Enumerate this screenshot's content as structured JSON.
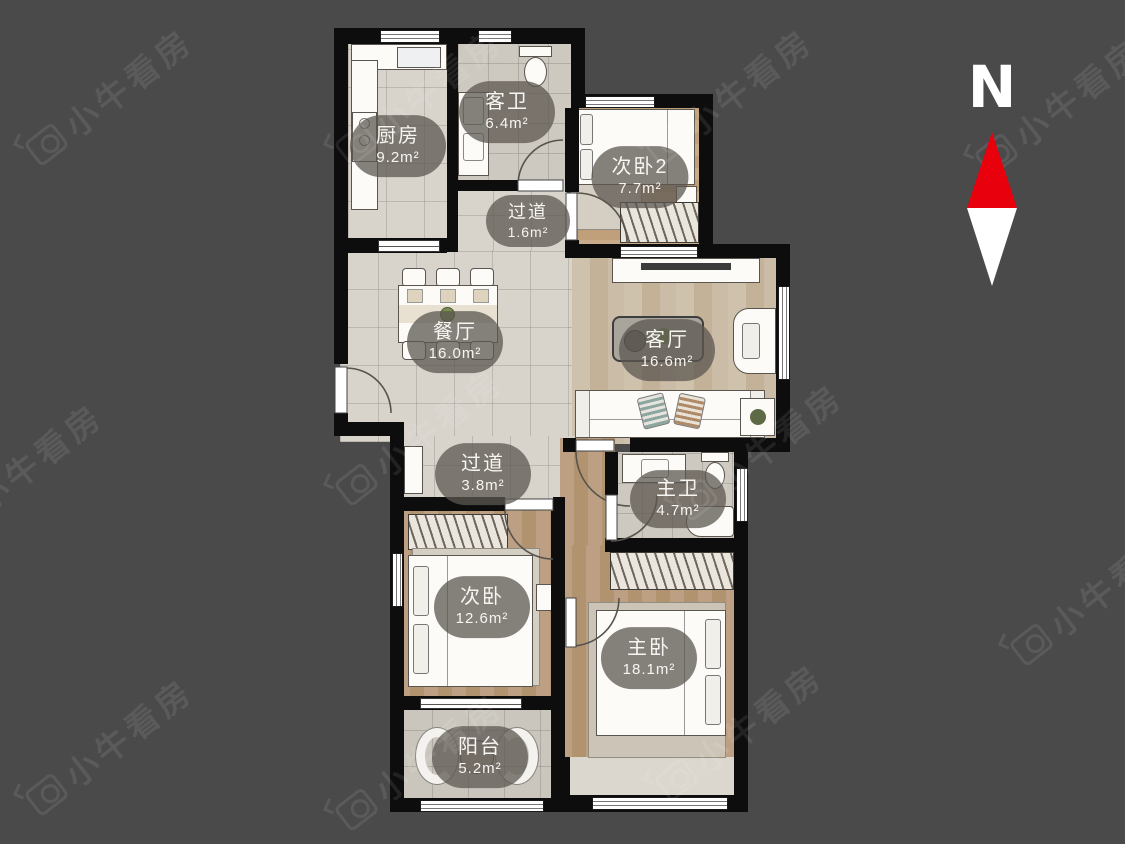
{
  "page": {
    "background": "#4a4a4b",
    "wall_color": "#0d0d0d"
  },
  "watermark": {
    "text": "小牛看房"
  },
  "compass": {
    "label": "N",
    "north_color": "#e8000d",
    "south_color": "#ffffff"
  },
  "floorplan": {
    "rooms": [
      {
        "id": "kitchen",
        "name": "厨房",
        "area": "9.2m²"
      },
      {
        "id": "guest-bathroom",
        "name": "客卫",
        "area": "6.4m²"
      },
      {
        "id": "bedroom-2",
        "name": "次卧2",
        "area": "7.7m²"
      },
      {
        "id": "passage-small",
        "name": "过道",
        "area": "1.6m²"
      },
      {
        "id": "dining-room",
        "name": "餐厅",
        "area": "16.0m²"
      },
      {
        "id": "living-room",
        "name": "客厅",
        "area": "16.6m²"
      },
      {
        "id": "passage",
        "name": "过道",
        "area": "3.8m²"
      },
      {
        "id": "master-bathroom",
        "name": "主卫",
        "area": "4.7m²"
      },
      {
        "id": "bedroom",
        "name": "次卧",
        "area": "12.6m²"
      },
      {
        "id": "master-bedroom",
        "name": "主卧",
        "area": "18.1m²"
      },
      {
        "id": "balcony",
        "name": "阳台",
        "area": "5.2m²"
      }
    ]
  }
}
